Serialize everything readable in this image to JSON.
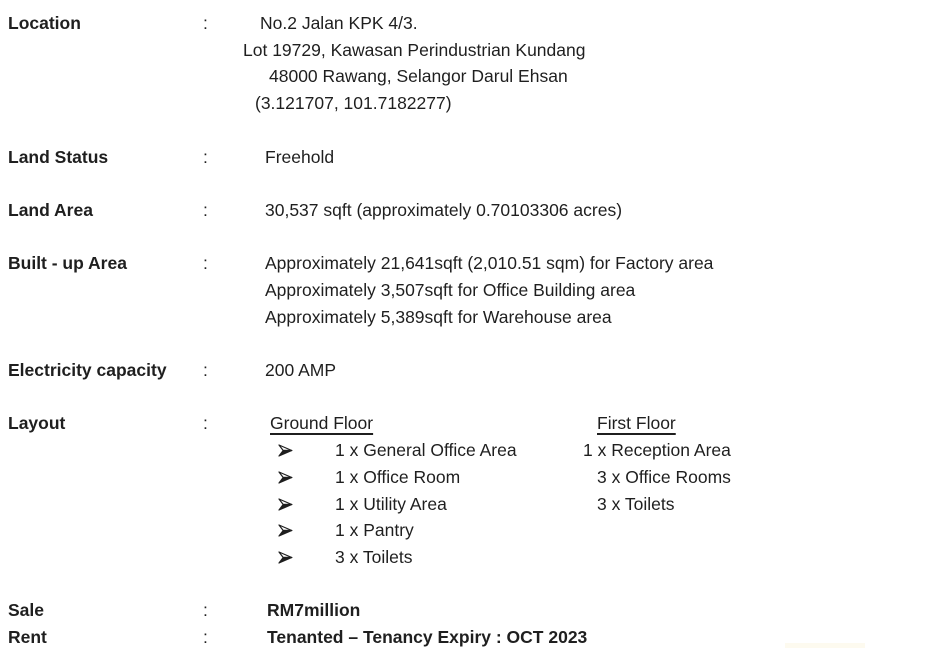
{
  "colon": ":",
  "colors": {
    "text": "#1f1f1f",
    "background": "#ffffff"
  },
  "icons": {
    "arrow_bullet": "➢"
  },
  "fields": {
    "location": {
      "label": "Location",
      "lines": [
        "No.2 Jalan KPK 4/3.",
        "Lot 19729, Kawasan Perindustrian Kundang",
        "48000 Rawang, Selangor Darul Ehsan",
        "(3.121707, 101.7182277)"
      ]
    },
    "land_status": {
      "label": "Land Status",
      "value": "Freehold"
    },
    "land_area": {
      "label": "Land Area",
      "value": "30,537 sqft (approximately 0.70103306 acres)"
    },
    "built_up_area": {
      "label": "Built - up Area",
      "lines": [
        "Approximately 21,641sqft (2,010.51 sqm) for Factory area",
        "Approximately 3,507sqft for Office Building area",
        "Approximately 5,389sqft for Warehouse area"
      ]
    },
    "electricity_capacity": {
      "label": "Electricity capacity",
      "value": "200 AMP"
    },
    "layout": {
      "label": "Layout",
      "ground_floor": {
        "title": "Ground Floor",
        "items": [
          "1 x General Office Area",
          "1 x Office Room",
          "1 x Utility Area",
          "1 x Pantry",
          "3 x Toilets"
        ]
      },
      "first_floor": {
        "title": "First Floor",
        "items": [
          "1 x Reception Area",
          "3 x Office Rooms",
          "3 x Toilets"
        ]
      }
    },
    "sale": {
      "label": "Sale",
      "value": "RM7million"
    },
    "rent": {
      "label": "Rent",
      "value": "Tenanted – Tenancy Expiry : OCT 2023"
    }
  }
}
